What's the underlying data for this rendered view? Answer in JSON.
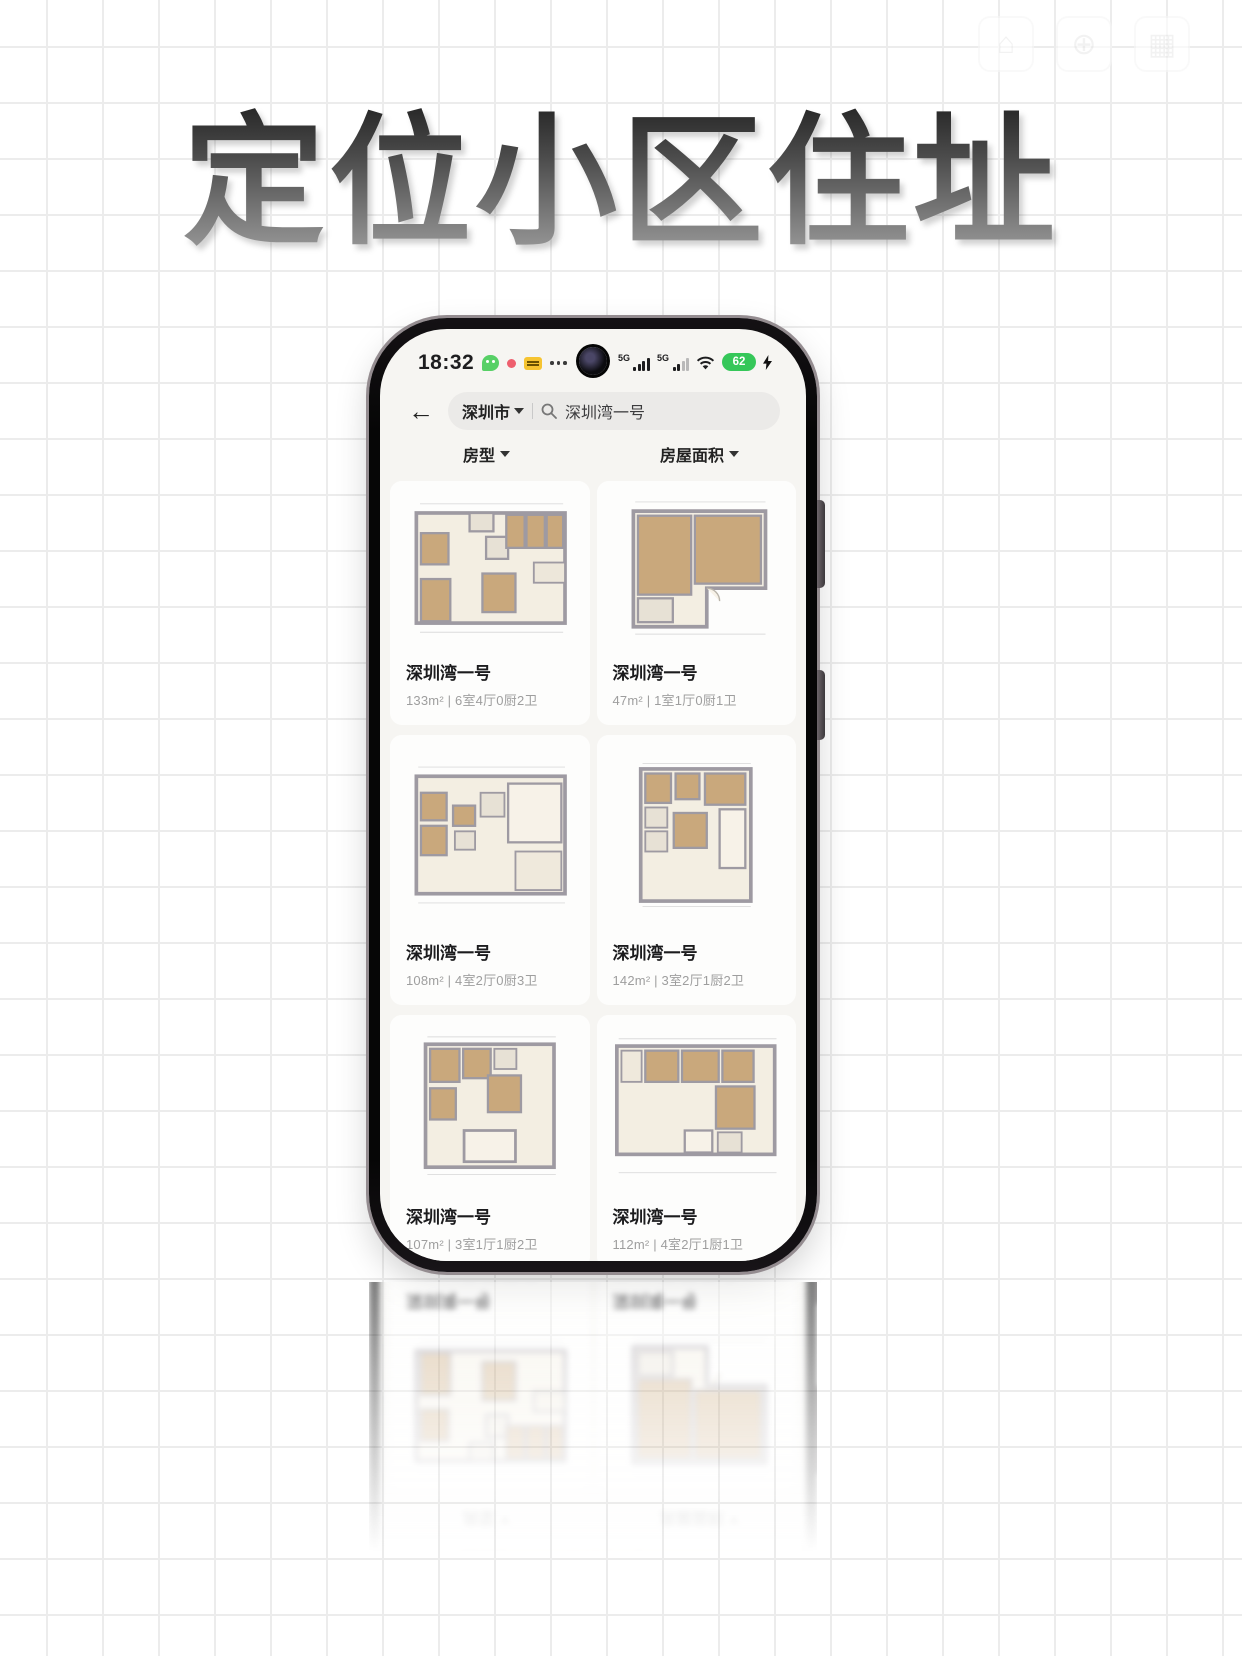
{
  "page": {
    "heading": "定位小区住址"
  },
  "corner_icons": {
    "home": "⌂",
    "globe": "⊕",
    "apps": "▦"
  },
  "phone": {
    "status_bar": {
      "time": "18:32",
      "network": "5G",
      "battery": "62"
    },
    "nav": {
      "city": "深圳市",
      "query": "深圳湾一号"
    },
    "filters": [
      {
        "label": "房型"
      },
      {
        "label": "房屋面积"
      }
    ],
    "listings": [
      {
        "name": "深圳湾一号",
        "spec": "133m² | 6室4厅0厨2卫"
      },
      {
        "name": "深圳湾一号",
        "spec": "47m² | 1室1厅0厨1卫"
      },
      {
        "name": "深圳湾一号",
        "spec": "108m² | 4室2厅0厨3卫"
      },
      {
        "name": "深圳湾一号",
        "spec": "142m² | 3室2厅1厨2卫"
      },
      {
        "name": "深圳湾一号",
        "spec": "107m² | 3室1厅1厨2卫"
      },
      {
        "name": "深圳湾一号",
        "spec": "112m² | 4室2厅1厨1卫"
      }
    ]
  },
  "colors": {
    "battery_green": "#35c759",
    "plan_room_tan": "#c9a87c",
    "plan_floor_cream": "#f3eee2",
    "plan_wall_gray": "#9e9aa2"
  }
}
